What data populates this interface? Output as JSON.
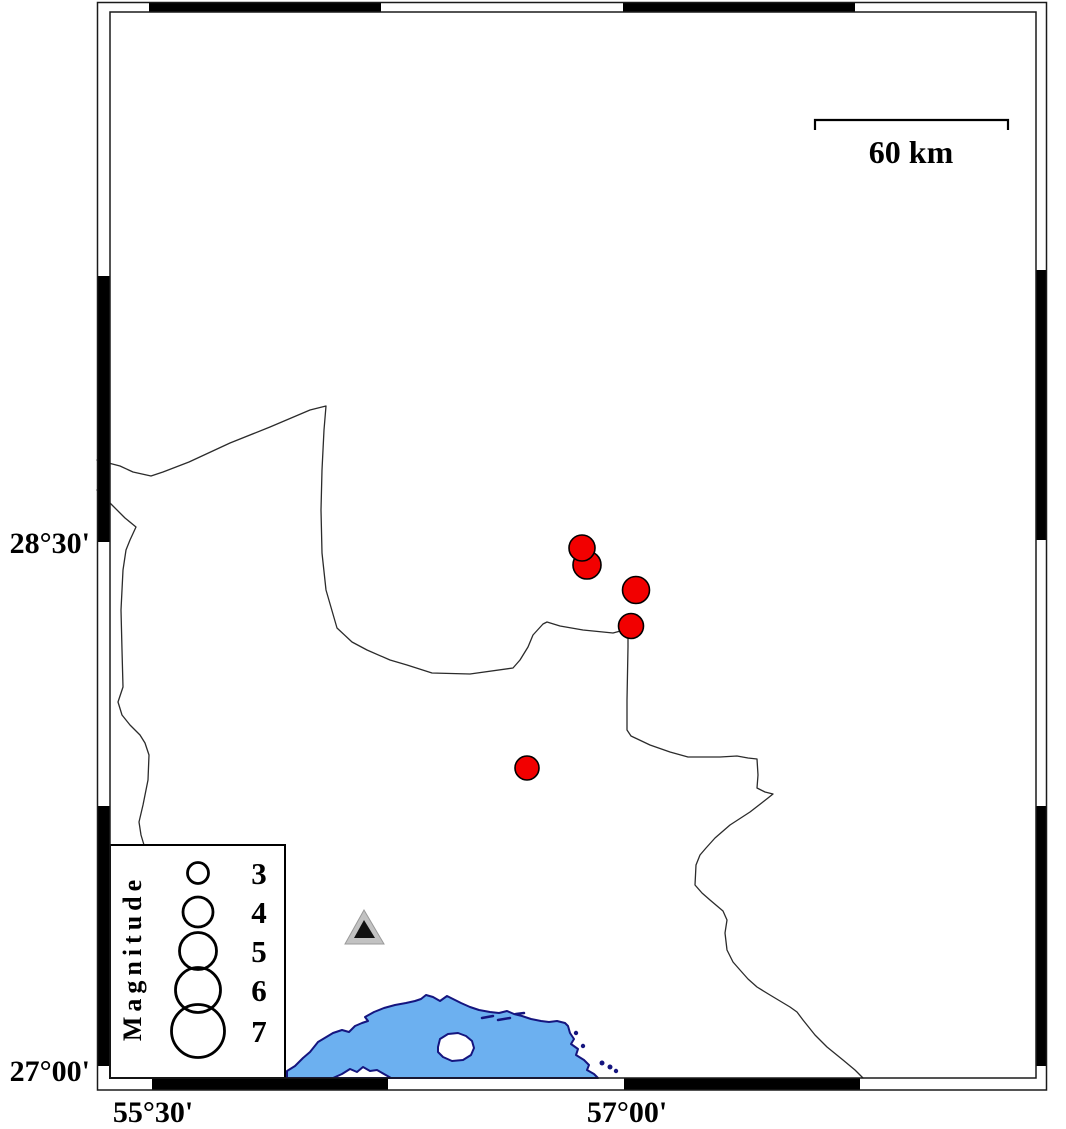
{
  "colors": {
    "sea_fill": "#6CB0F0",
    "coast_stroke": "#15157F",
    "earthquake_fill": "#F20000",
    "frame_stroke": "#1a1a1a",
    "station_gray": "#C2C2C2",
    "station_black": "#111111"
  },
  "frame": {
    "lat_label_top": "28°30'",
    "lat_label_bottom": "27°00'",
    "lon_label_left": "55°30'",
    "lon_label_right": "57°00'"
  },
  "scale_bar": {
    "label": "60 km"
  },
  "legend": {
    "title": "Magnitude",
    "circle_x": 198,
    "label_x": 259,
    "items": [
      {
        "magnitude": "3",
        "y": 873,
        "r": 10.5
      },
      {
        "magnitude": "4",
        "y": 912,
        "r": 15
      },
      {
        "magnitude": "5",
        "y": 951,
        "r": 18.5
      },
      {
        "magnitude": "6",
        "y": 990,
        "r": 22.5
      },
      {
        "magnitude": "7",
        "y": 1031,
        "r": 26.5
      }
    ]
  },
  "map": {
    "earthquakes": [
      {
        "x": 587,
        "y": 565,
        "r": 14
      },
      {
        "x": 582,
        "y": 548,
        "r": 13
      },
      {
        "x": 636,
        "y": 590,
        "r": 13.5
      },
      {
        "x": 631,
        "y": 626,
        "r": 12.5
      },
      {
        "x": 527,
        "y": 768,
        "r": 12
      }
    ],
    "station": {
      "x": 364,
      "y": 930
    }
  }
}
